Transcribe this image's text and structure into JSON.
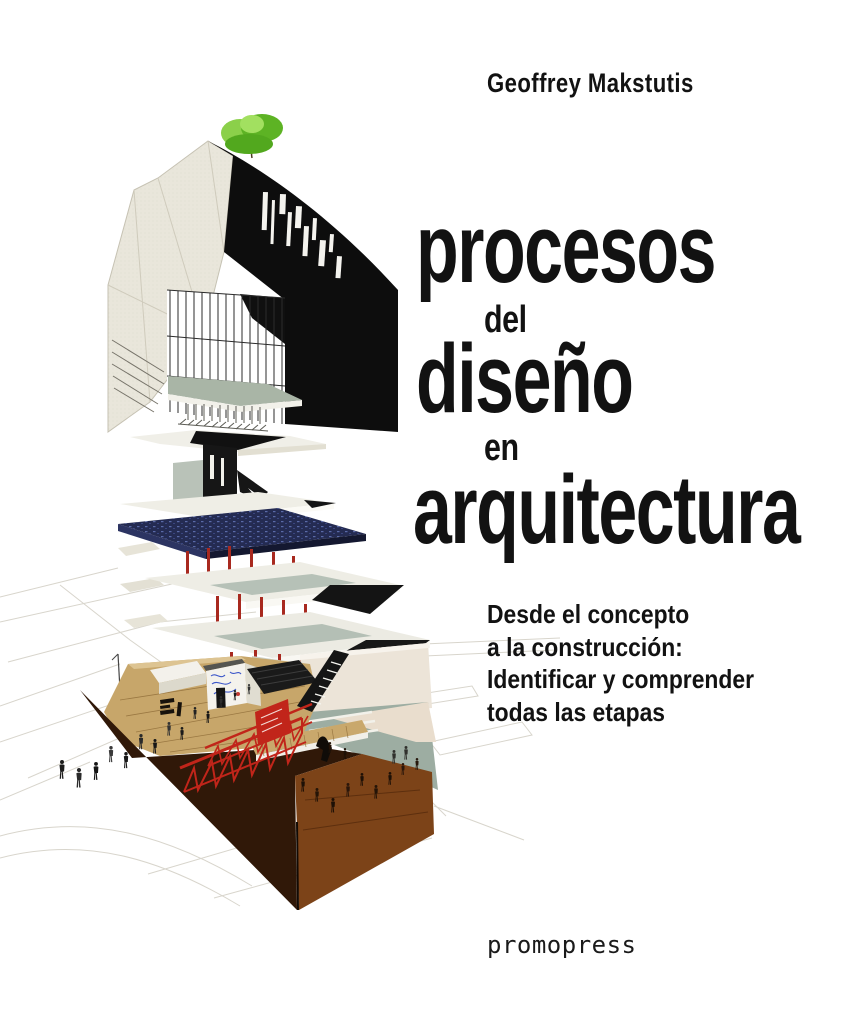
{
  "cover": {
    "author": "Geoffrey Makstutis",
    "title_lines": [
      {
        "text": "procesos",
        "size": "large"
      },
      {
        "text": "del",
        "size": "small"
      },
      {
        "text": "diseño",
        "size": "large"
      },
      {
        "text": "en",
        "size": "small"
      },
      {
        "text": "arquitectura",
        "size": "large"
      }
    ],
    "subtitle_lines": [
      "Desde el concepto",
      "a la construcción:",
      "Identificar y comprender",
      "todas las etapas"
    ],
    "publisher": "promopress",
    "colors": {
      "background": "#ffffff",
      "text": "#121212",
      "tree_green": "#5db324",
      "slab_blue": "#242b52",
      "structure_red": "#c1251a",
      "deck_tan": "#c7a66a",
      "excavation_brown": "#301808",
      "rust_floor": "#7c4318",
      "sage_green": "#9dada2",
      "facade_cream": "#e9e6db",
      "building_black": "#0d0d0d"
    },
    "illustration_alt": "Exploded axonometric architectural drawing: building massing with rooftop tree and glass curtain wall above stacked floor plates with red columns, over a construction site with red trusses, excavation and pedestrians"
  }
}
